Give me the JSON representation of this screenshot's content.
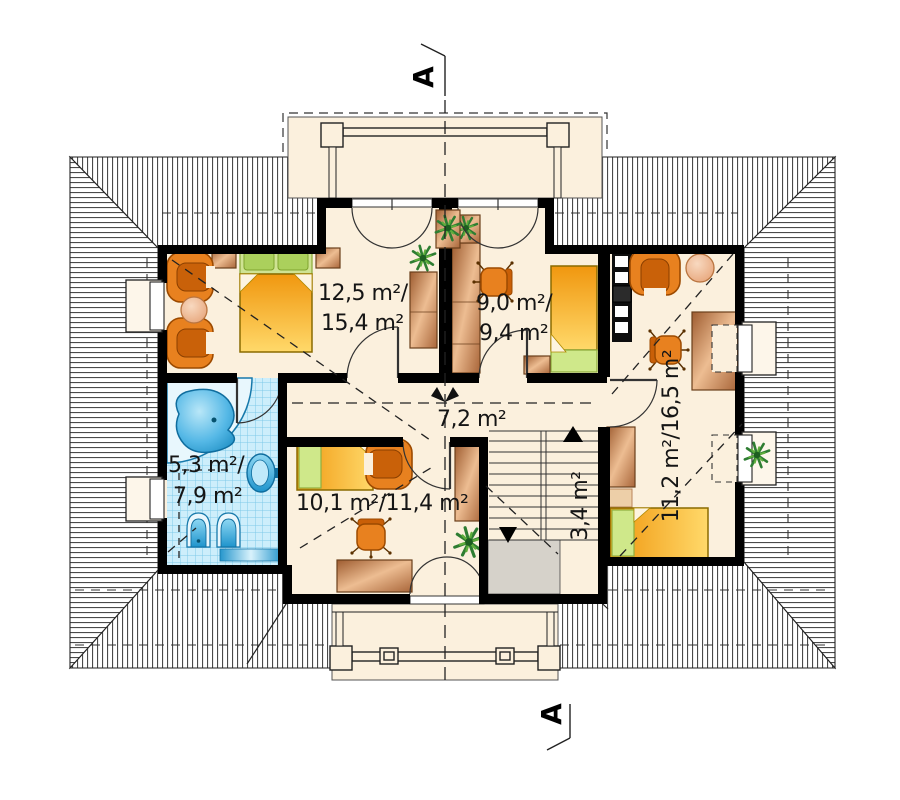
{
  "plan": {
    "type": "floor-plan",
    "level": "attic-storey",
    "section_markers": {
      "top": "A",
      "bottom": "A"
    },
    "rooms": {
      "bedroom": {
        "area_line1": "12,5 m²/",
        "area_line2": "15,4 m²"
      },
      "room_small": {
        "area_line1": "9,0 m²/",
        "area_line2": "9,4 m²"
      },
      "hall": {
        "area": "7,2 m²"
      },
      "bathroom": {
        "area_line1": "5,3 m²/",
        "area_line2": "7,9 m²"
      },
      "room_bottom": {
        "area": "10,1 m²/11,4 m²"
      },
      "room_right": {
        "area": "11,2 m²/16,5 m²"
      },
      "stairs": {
        "area": "3,4 m²"
      }
    },
    "colors": {
      "floor_cream": "#fbf0dd",
      "wall_black": "#000000",
      "bathroom_tile": "#cdeefb",
      "fixture_blue": "#2aa3d9",
      "furniture_orange": "#e8811f",
      "furniture_wood": "#b5713f",
      "bed_yellow": "#ffd96a",
      "pillow_green": "#bcd977",
      "stairwell_gray": "#d6d2ca"
    }
  }
}
